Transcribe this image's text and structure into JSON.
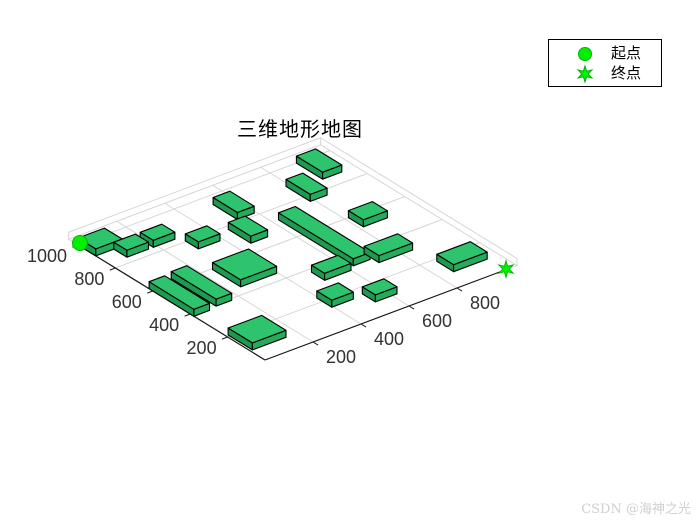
{
  "title": {
    "text": "三维地形地图"
  },
  "legend": {
    "items": [
      {
        "marker": "circle",
        "label": "起点"
      },
      {
        "marker": "hexagram",
        "label": "终点"
      }
    ]
  },
  "watermark": {
    "text": "CSDN @海神之光"
  },
  "colors": {
    "marker_fill": "#00f000",
    "marker_stroke": "#00b400",
    "block_top": "#2ec46d",
    "block_side_x": "#1c9a50",
    "block_side_y": "#24ab5c",
    "block_edge": "#000000",
    "grid": "#d6d6d6",
    "axis_line": "#1a1a1a",
    "tick_label": "#333333"
  },
  "chart_data": {
    "type": "3d-terrain-obstacle-map",
    "title": "三维地形地图",
    "x_range": [
      0,
      1000
    ],
    "y_range": [
      0,
      1000
    ],
    "grid_extent": 1050,
    "grid_step": 200,
    "x_ticks": [
      200,
      400,
      600,
      800
    ],
    "y_ticks": [
      200,
      400,
      600,
      800,
      1000
    ],
    "start_point": {
      "x": 0,
      "y": 1000,
      "label": "起点"
    },
    "end_point": {
      "x": 1000,
      "y": 0,
      "label": "终点"
    },
    "obstacles": [
      [
        910,
        860,
        80,
        140
      ],
      [
        785,
        765,
        70,
        130
      ],
      [
        520,
        815,
        70,
        130
      ],
      [
        455,
        660,
        70,
        120
      ],
      [
        815,
        520,
        100,
        80
      ],
      [
        625,
        330,
        70,
        400
      ],
      [
        0,
        905,
        110,
        95
      ],
      [
        75,
        835,
        90,
        70
      ],
      [
        185,
        835,
        90,
        70
      ],
      [
        295,
        735,
        90,
        70
      ],
      [
        705,
        295,
        140,
        80
      ],
      [
        860,
        95,
        140,
        90
      ],
      [
        245,
        445,
        150,
        150
      ],
      [
        490,
        310,
        110,
        70
      ],
      [
        100,
        390,
        65,
        240
      ],
      [
        0,
        380,
        65,
        240
      ],
      [
        395,
        150,
        90,
        80
      ],
      [
        530,
        90,
        90,
        70
      ],
      [
        10,
        80,
        140,
        130
      ]
    ]
  }
}
